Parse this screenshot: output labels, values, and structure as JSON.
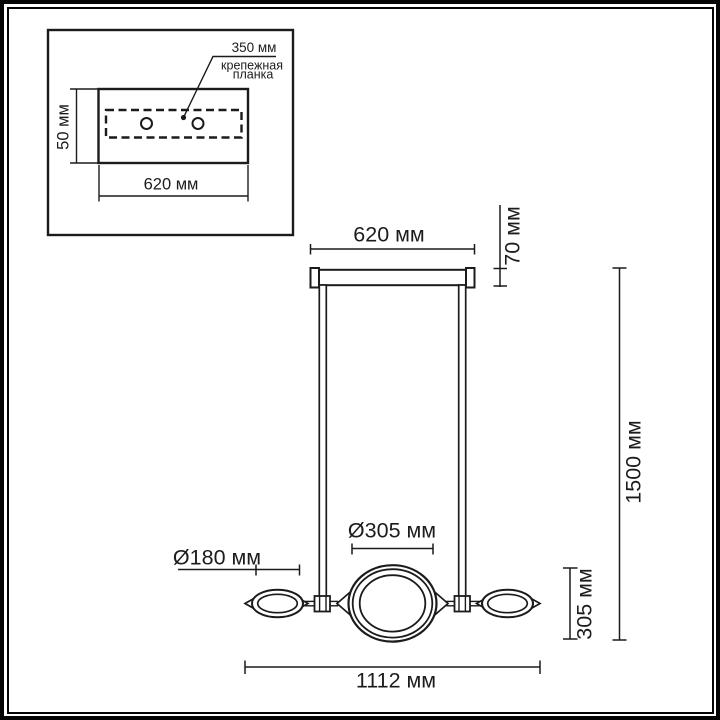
{
  "drawing": {
    "type": "pendant-lamp-dimension-drawing",
    "units": "мм",
    "line_color": "#1b1b1b",
    "background": "#ffffff"
  },
  "inset": {
    "bracket_length": "350 мм",
    "bracket_label_line1": "крепежная",
    "bracket_label_line2": "планка",
    "plate_height": "50 мм",
    "plate_width": "620 мм"
  },
  "main": {
    "canopy_width": "620 мм",
    "canopy_height": "70 мм",
    "overall_height": "1500 мм",
    "center_ring_diameter": "Ø305 мм",
    "side_shade_diameter": "Ø180 мм",
    "body_height": "305 мм",
    "overall_width": "1112 мм"
  }
}
